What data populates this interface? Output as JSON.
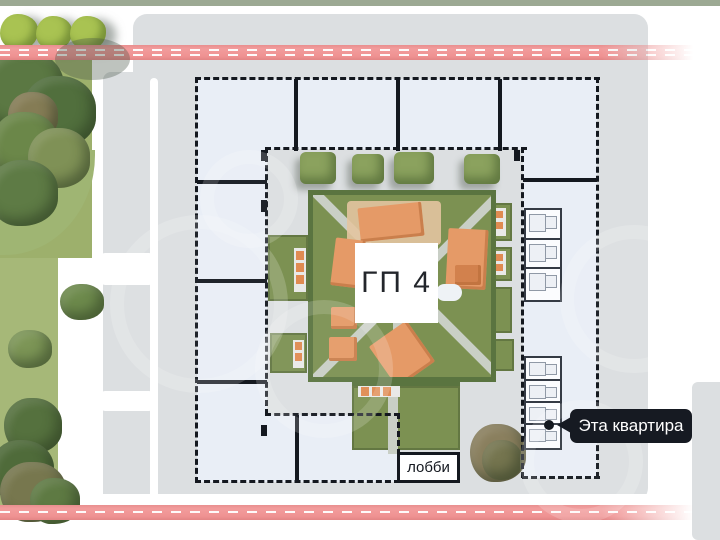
{
  "site_plan": {
    "building_label": "ГП 4",
    "lobby_label": "лобби",
    "apartment_tooltip": "Эта квартира"
  },
  "markers": {
    "selected_apartment_dot": "black-dot"
  },
  "colors": {
    "road_pink": "#ef9292",
    "road_dash_white": "#ffffff",
    "building_fill": "#e9eef6",
    "plan_outline": "#14181f",
    "site_gray": "#dcdfe1",
    "courtyard_green": "#7c9152",
    "hedge_dark_green": "#5a7440",
    "playground_orange": "#e59a67",
    "park_tree_green": "#5e7a45",
    "tooltip_bg": "#161a22",
    "tooltip_text": "#ffffff"
  }
}
